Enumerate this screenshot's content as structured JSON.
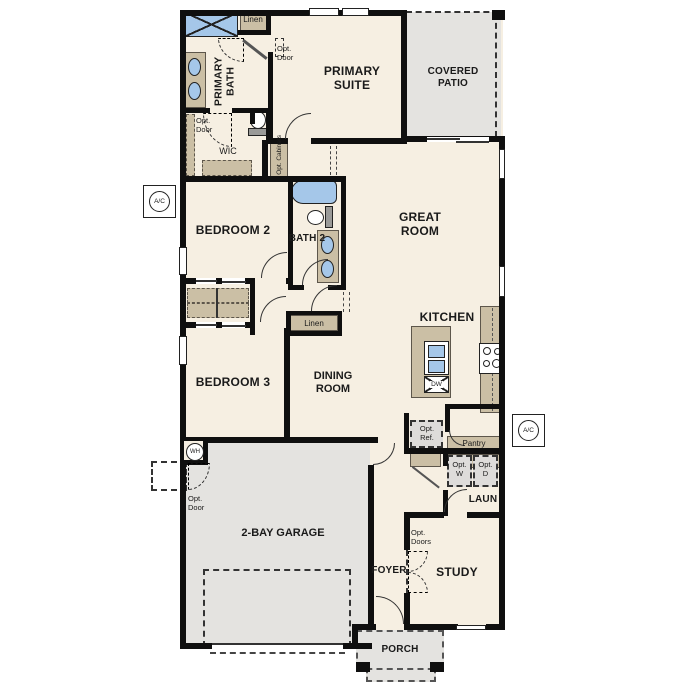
{
  "plan": {
    "rooms": {
      "primary_bath": "PRIMARY BATH",
      "primary_suite": "PRIMARY SUITE",
      "covered_patio": "COVERED PATIO",
      "wic": "WIC",
      "bedroom2": "BEDROOM 2",
      "bath2": "BATH 2",
      "great_room": "GREAT ROOM",
      "bedroom3": "BEDROOM 3",
      "dining_room": "DINING ROOM",
      "kitchen": "KITCHEN",
      "laundry": "LAUN",
      "garage": "2-BAY GARAGE",
      "foyer": "FOYER",
      "study": "STUDY",
      "porch": "PORCH"
    },
    "annotations": {
      "linen_top": "Linen",
      "linen_hall": "Linen",
      "opt_door_bath": "Opt. Door",
      "opt_door_wic": "Opt. Door",
      "opt_door_garage": "Opt. Door",
      "opt_doors_study": "Opt. Doors",
      "opt_cabinets": "Opt. Cabinets",
      "opt_ref": "Opt. Ref.",
      "opt_washer": "Opt. W",
      "opt_dryer": "Opt. D",
      "pantry": "Pantry",
      "dishwasher": "DW",
      "ac_unit": "A/C",
      "water_heater": "WH"
    },
    "colors": {
      "floor": "#f6efe2",
      "cabinet_tan": "#cbbfa5",
      "fixture_blue": "#a5c7e9",
      "concrete_gray": "#e4e3e0",
      "appliance_gray": "#dedcda",
      "wall_black": "#0f0f0f"
    }
  }
}
